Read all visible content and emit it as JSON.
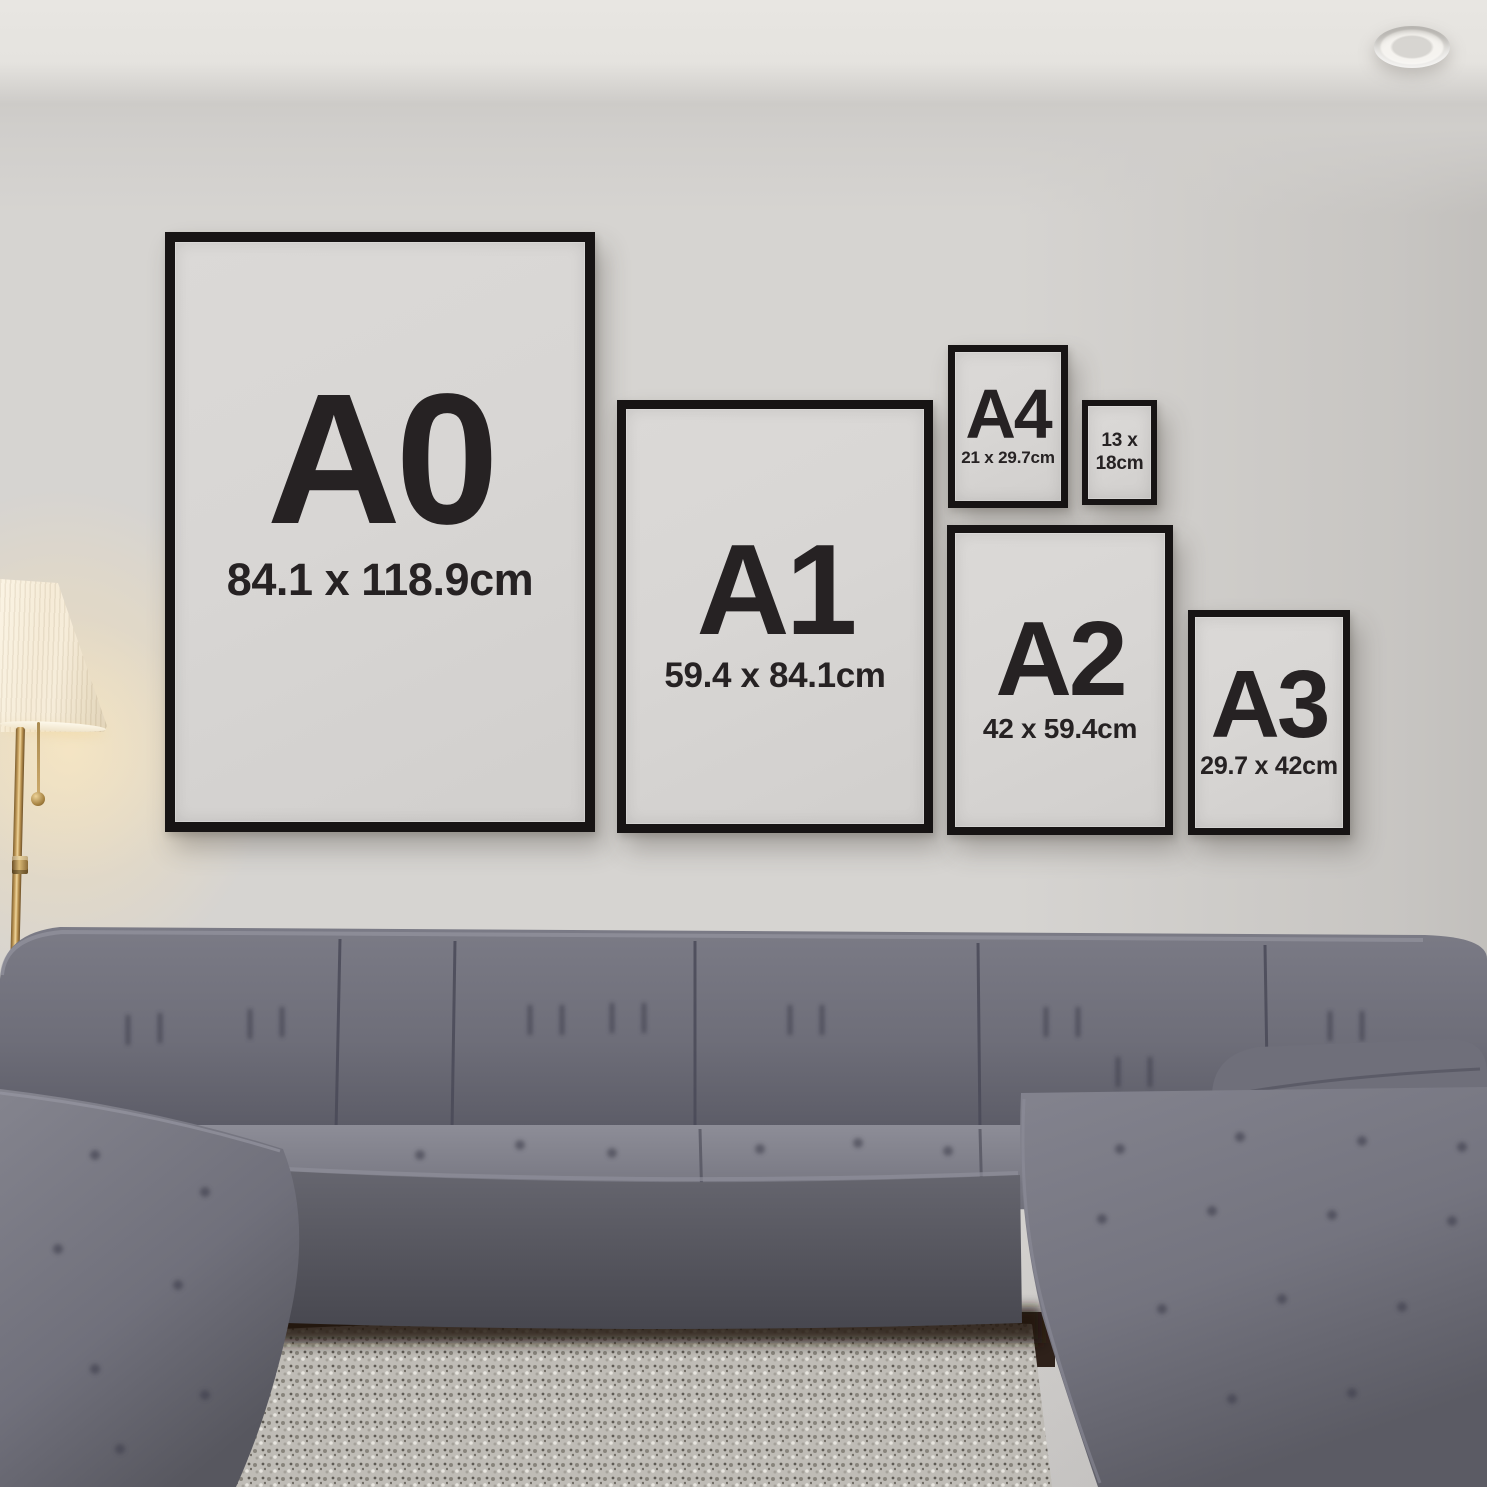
{
  "frames": [
    {
      "id": "a0",
      "label": "A0",
      "dimensions": "84.1 x 118.9cm"
    },
    {
      "id": "a1",
      "label": "A1",
      "dimensions": "59.4 x 84.1cm"
    },
    {
      "id": "a4",
      "label": "A4",
      "dimensions": "21 x 29.7cm"
    },
    {
      "id": "13x18",
      "label": "13 x",
      "dimensions": "18cm"
    },
    {
      "id": "a2",
      "label": "A2",
      "dimensions": "42 x 59.4cm"
    },
    {
      "id": "a3",
      "label": "A3",
      "dimensions": "29.7 x 42cm"
    }
  ],
  "colors": {
    "wall": "#D6D4D1",
    "ceiling": "#E8E6E2",
    "frame_black": "#171414",
    "paper": "#D8D6D4",
    "ink": "#262223",
    "sofa_mid": "#74747F",
    "sofa_dark": "#4E4E5A",
    "sofa_light": "#8A8A93",
    "rug": "#C7C4BE",
    "lamp_shade": "#F6ECD8",
    "brass": "#C8A260",
    "glow": "#FAE2B2"
  }
}
